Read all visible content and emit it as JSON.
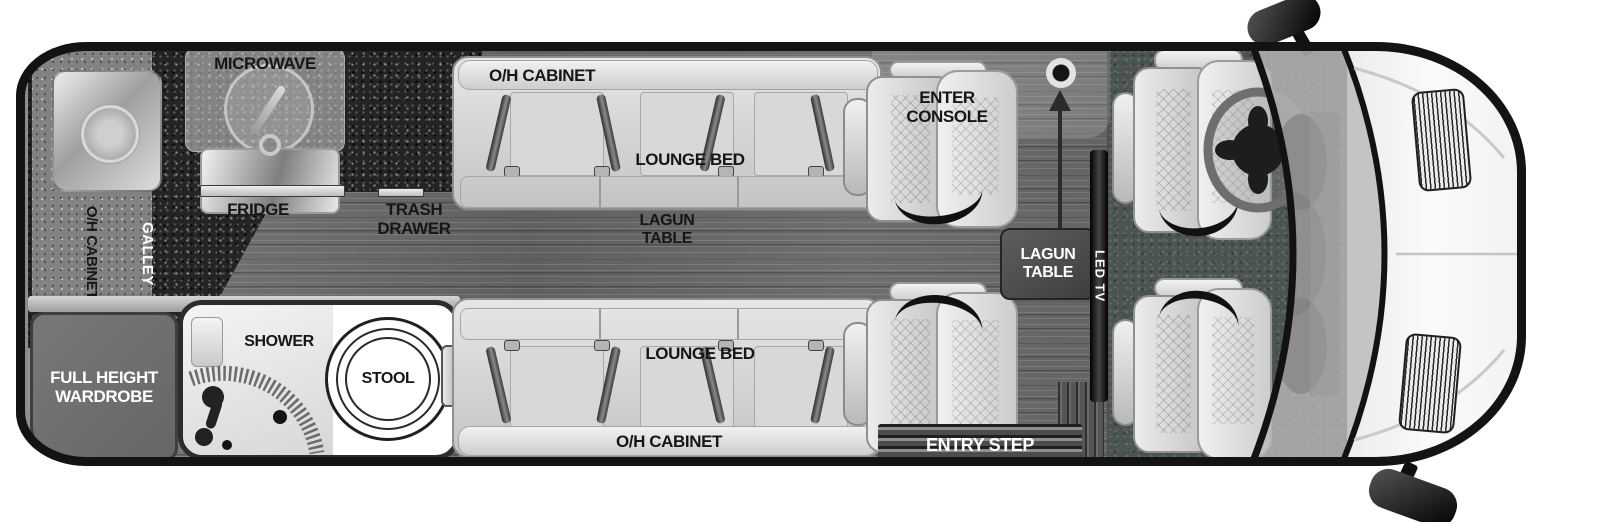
{
  "floorplan": {
    "title": "RV floor plan",
    "labels": {
      "microwave": "MICROWAVE",
      "oh_cabinet_rear": "O/H CABINET",
      "galley": "GALLEY",
      "fridge": "FRIDGE",
      "trash_drawer": "TRASH\nDRAWER",
      "oh_cabinet_top": "O/H CABINET",
      "lounge_bed_top": "LOUNGE BED",
      "lagun_table_floor": "LAGUN\nTABLE",
      "enter_console": "ENTER\nCONSOLE",
      "lounge_bed_bottom": "LOUNGE BED",
      "oh_cabinet_bottom": "O/H CABINET",
      "full_height_wardrobe": "FULL HEIGHT\nWARDROBE",
      "shower": "SHOWER",
      "stool": "STOOL",
      "lagun_table_mount": "LAGUN\nTABLE",
      "led_tv": "LED TV",
      "entry_step": "ENTRY STEP"
    },
    "colors": {
      "body_outline": "#131313",
      "wood_floor": "#6f6f6f",
      "galley_counter": "#242424",
      "overhead_cabinet": "#828282",
      "cab_carpet": "#4b5450",
      "upholstery": "#d9d9d9",
      "hood": "#f2f2f2",
      "table": "#4f4f4f",
      "tv_black": "#111111",
      "label_dark": "#161616",
      "label_light": "#ffffff"
    }
  }
}
